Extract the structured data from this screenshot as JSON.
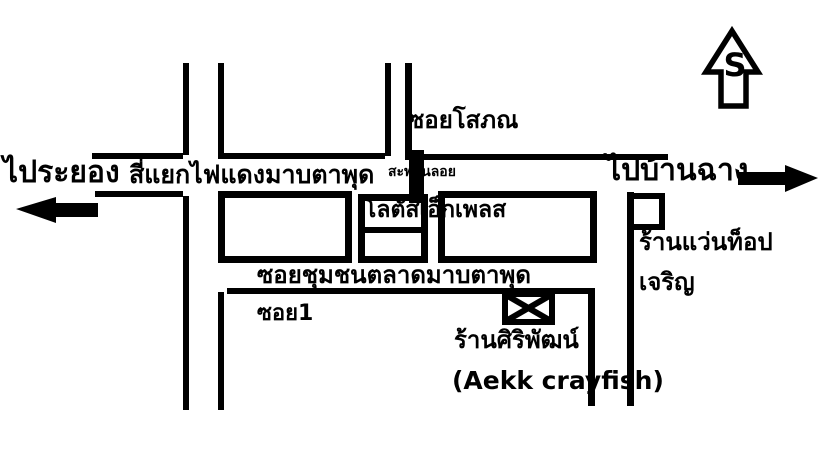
{
  "map": {
    "background_color": "#ffffff",
    "ink_color": "#000000",
    "compass": {
      "letter": "S"
    },
    "directions": {
      "to_rayong": "ไประยอง",
      "to_ban_chang": "ไปบ้านฉาง"
    },
    "roads": {
      "intersection_label": "สี่แยกไฟแดงมาบตาพุด",
      "footbridge_label": "สะพานลอย",
      "soi_sophon_label": "ซอยโสภณ",
      "soi_market_label": "ซอยชุมชนตลาดมาบตาพุด",
      "soi_1_label": "ซอย1"
    },
    "places": {
      "lotus_express": "โลตัสเอ็กเพลส",
      "optical_shop_line1": "ร้านแว่นท็อป",
      "optical_shop_line2": "เจริญ",
      "crayfish_shop_th": "ร้านศิริพัฒน์",
      "crayfish_shop_en": "(Aekk crayfish)"
    }
  }
}
